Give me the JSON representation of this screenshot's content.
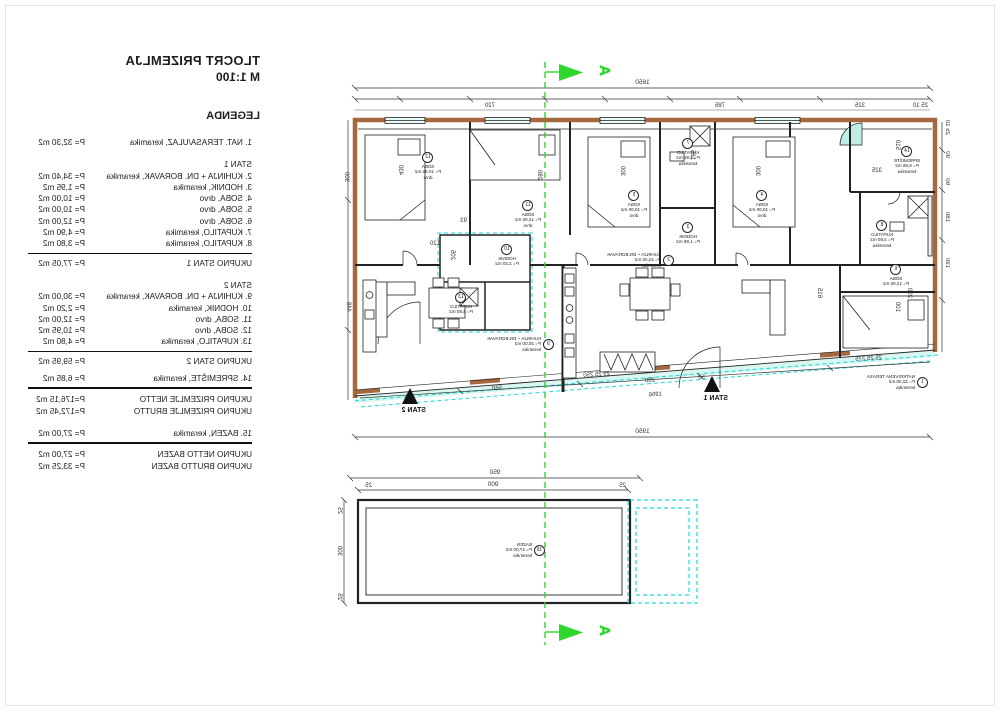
{
  "title": {
    "line1": "TLOCRT PRIZEMLJA",
    "line2": "M 1:100",
    "legend_heading": "LEGENDA"
  },
  "legend": {
    "rows": [
      {
        "type": "item",
        "label": "1. NAT. TERASA/ULAZ, keramika",
        "value": "P= 32,30 m2"
      },
      {
        "type": "gap"
      },
      {
        "type": "header",
        "label": "STAN 1"
      },
      {
        "type": "item",
        "label": "2. KUHINJA + DN. BORAVAK, keramika",
        "value": "P= 34,40 m2"
      },
      {
        "type": "item",
        "label": "3. HODNIK, keramika",
        "value": "P= 1,95 m2"
      },
      {
        "type": "item",
        "label": "4. SOBA, drvo",
        "value": "P= 10,00 m2"
      },
      {
        "type": "item",
        "label": "5. SOBA, drvo",
        "value": "P= 10,00 m2"
      },
      {
        "type": "item",
        "label": "6. SOBA, drvo",
        "value": "P= 12,00 m2"
      },
      {
        "type": "item",
        "label": "7. KUPATILO, keramika",
        "value": "P= 4,90 m2"
      },
      {
        "type": "item",
        "label": "8. KUPATILO, keramika",
        "value": "P= 3,80 m2"
      },
      {
        "type": "rule"
      },
      {
        "type": "total",
        "label": "UKUPNO STAN 1",
        "value": "P= 77,05 m2"
      },
      {
        "type": "gap"
      },
      {
        "type": "header",
        "label": "STAN 2"
      },
      {
        "type": "item",
        "label": "9. KUHINJA + DN. BORAVAK, keramika",
        "value": "P= 30,00 m2"
      },
      {
        "type": "item",
        "label": "10. HODNIK, keramika",
        "value": "P= 2,20 m2"
      },
      {
        "type": "item",
        "label": "11. SOBA, drvo",
        "value": "P= 12,00 m2"
      },
      {
        "type": "item",
        "label": "12. SOBA, drvo",
        "value": "P= 10,95 m2"
      },
      {
        "type": "item",
        "label": "13. KUPATILO, keramika",
        "value": "P= 4,80 m2"
      },
      {
        "type": "rule"
      },
      {
        "type": "total",
        "label": "UKUPNO STAN 2",
        "value": "P= 59,95 m2"
      },
      {
        "type": "gapsm"
      },
      {
        "type": "item",
        "label": "14. SPREMIŠTE, keramika",
        "value": "P= 6,85 m2"
      },
      {
        "type": "rule2"
      },
      {
        "type": "total",
        "label": "UKUPNO PRIZEMLJE NETTO",
        "value": "P=176,15 m2"
      },
      {
        "type": "total",
        "label": "UKUPNO PRIZEMLJE BRUTTO",
        "value": "P=172,45 m2"
      },
      {
        "type": "gap"
      },
      {
        "type": "item",
        "label": "15. BAZEN, keramika",
        "value": "P= 27,00 m2"
      },
      {
        "type": "rule2"
      },
      {
        "type": "total",
        "label": "UKUPNO NETTO BAZEN",
        "value": "P= 27,00 m2"
      },
      {
        "type": "total",
        "label": "UKUPNO BRUTTO BAZEN",
        "value": "P= 33,25 m2"
      }
    ]
  },
  "plan": {
    "section_letter": "A",
    "stan1_label": "STAN 1",
    "stan2_label": "STAN 2",
    "rooms": [
      {
        "num": "1",
        "name": "NATKRIVENA TERASA",
        "area": "P= 32,30 m2",
        "mat": "keramika"
      },
      {
        "num": "2",
        "name": "KUHINJA + DN.BORAVAK",
        "area": "P= 34,40 m2",
        "mat": "keramika"
      },
      {
        "num": "9",
        "name": "KUHINJA + DN.BORAVAK",
        "area": "P= 30,00 m2",
        "mat": "keramika"
      },
      {
        "num": "12",
        "name": "SOBA",
        "area": "P= 10,95 m2",
        "mat": "drvo"
      },
      {
        "num": "11",
        "name": "SOBA",
        "area": "P= 12,00 m2",
        "mat": "drvo"
      },
      {
        "num": "5",
        "name": "SOBA",
        "area": "P= 10,00 m2",
        "mat": "drvo"
      },
      {
        "num": "4",
        "name": "SOBA",
        "area": "P= 10,00 m2",
        "mat": "drvo"
      },
      {
        "num": "7",
        "name": "KUPATILO",
        "area": "P= 4,90 m2",
        "mat": "keramika"
      },
      {
        "num": "8",
        "name": "KUPATILO",
        "area": "P= 3,80 m2",
        "mat": "keramika"
      },
      {
        "num": "14",
        "name": "SPREMIŠTE",
        "area": "P= 6,85 m2",
        "mat": "keramika"
      },
      {
        "num": "6",
        "name": "SOBA",
        "area": "P= 12,00 m2",
        "mat": "drvo"
      },
      {
        "num": "3",
        "name": "HODNIK",
        "area": "P= 1,95 m2",
        "mat": "keramika"
      },
      {
        "num": "10",
        "name": "HODNIK",
        "area": "P= 2,20 m2",
        "mat": "keramika"
      },
      {
        "num": "13",
        "name": "KUPATILO",
        "area": "P= 4,80 m2",
        "mat": "keramika"
      },
      {
        "num": "15",
        "name": "BAZEN",
        "area": "P= 27,00 m2",
        "mat": "keramika"
      }
    ],
    "chains": {
      "top_total": "1650",
      "bottom_total": "1950",
      "pool_total": "950",
      "pool_inner": "900",
      "top": [
        {
          "v": "25"
        },
        {
          "v": "185"
        },
        {
          "v": "80"
        },
        {
          "v": "145"
        },
        {
          "v": "100"
        },
        {
          "v": "150"
        },
        {
          "v": "80"
        },
        {
          "v": "255"
        },
        {
          "v": "100"
        },
        {
          "v": "185"
        },
        {
          "v": "120"
        },
        {
          "v": "180"
        },
        {
          "v": "200"
        },
        {
          "v": "120"
        },
        {
          "v": "25"
        }
      ]
    },
    "dims": {
      "d2510": "25 10",
      "d325b": "325",
      "d785": "785",
      "d720": "720",
      "d430": "430",
      "d280": "280",
      "d300a": "300",
      "d300b": "300",
      "d165": "165",
      "d510": "510",
      "d325": "325",
      "d205": "205",
      "d93": "93",
      "d120": "120",
      "d615": "615",
      "d200i": "200",
      "d100i": "100",
      "d560": "560",
      "d200b": "200",
      "d1956": "1956",
      "d250b": "25 25 250",
      "d275b": "25 25 275",
      "d50": "50",
      "dl1": "25 10",
      "dl2": "90",
      "dl3": "60",
      "dl4": "180",
      "dl5": "190",
      "dr1": "300",
      "dr2": "448",
      "ps1": "25",
      "ps2": "300",
      "ps3": "25",
      "pool25a": "25",
      "pool25b": "25"
    },
    "colors": {
      "wall": "#a5683f",
      "cyan": "#1ad9d9",
      "green": "#2ed62e",
      "terrace_fill": "#d9f6f0"
    }
  }
}
